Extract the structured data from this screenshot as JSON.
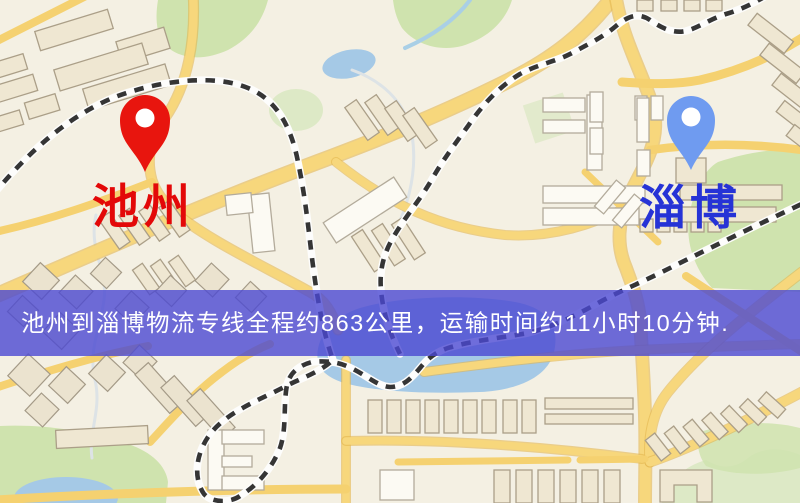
{
  "banner": {
    "text": "池州到淄博物流专线全程约863公里，运输时间约11小时10分钟.",
    "distance_text": "约863公里",
    "duration_text": "约11小时10分钟",
    "bg_color": "#4b49d2",
    "text_color": "#ffffff"
  },
  "origin": {
    "name": "池州",
    "label_color": "#e30808",
    "pin_color": "#e8150e"
  },
  "destination": {
    "name": "淄博",
    "label_color": "#2633d6",
    "pin_color": "#6f9bf0"
  },
  "map_palette": {
    "background": "#f4f0e3",
    "road": "#f7d77c",
    "railway_dash": "#353535",
    "green": "#cfe3ae",
    "water": "#a5c9e6"
  }
}
